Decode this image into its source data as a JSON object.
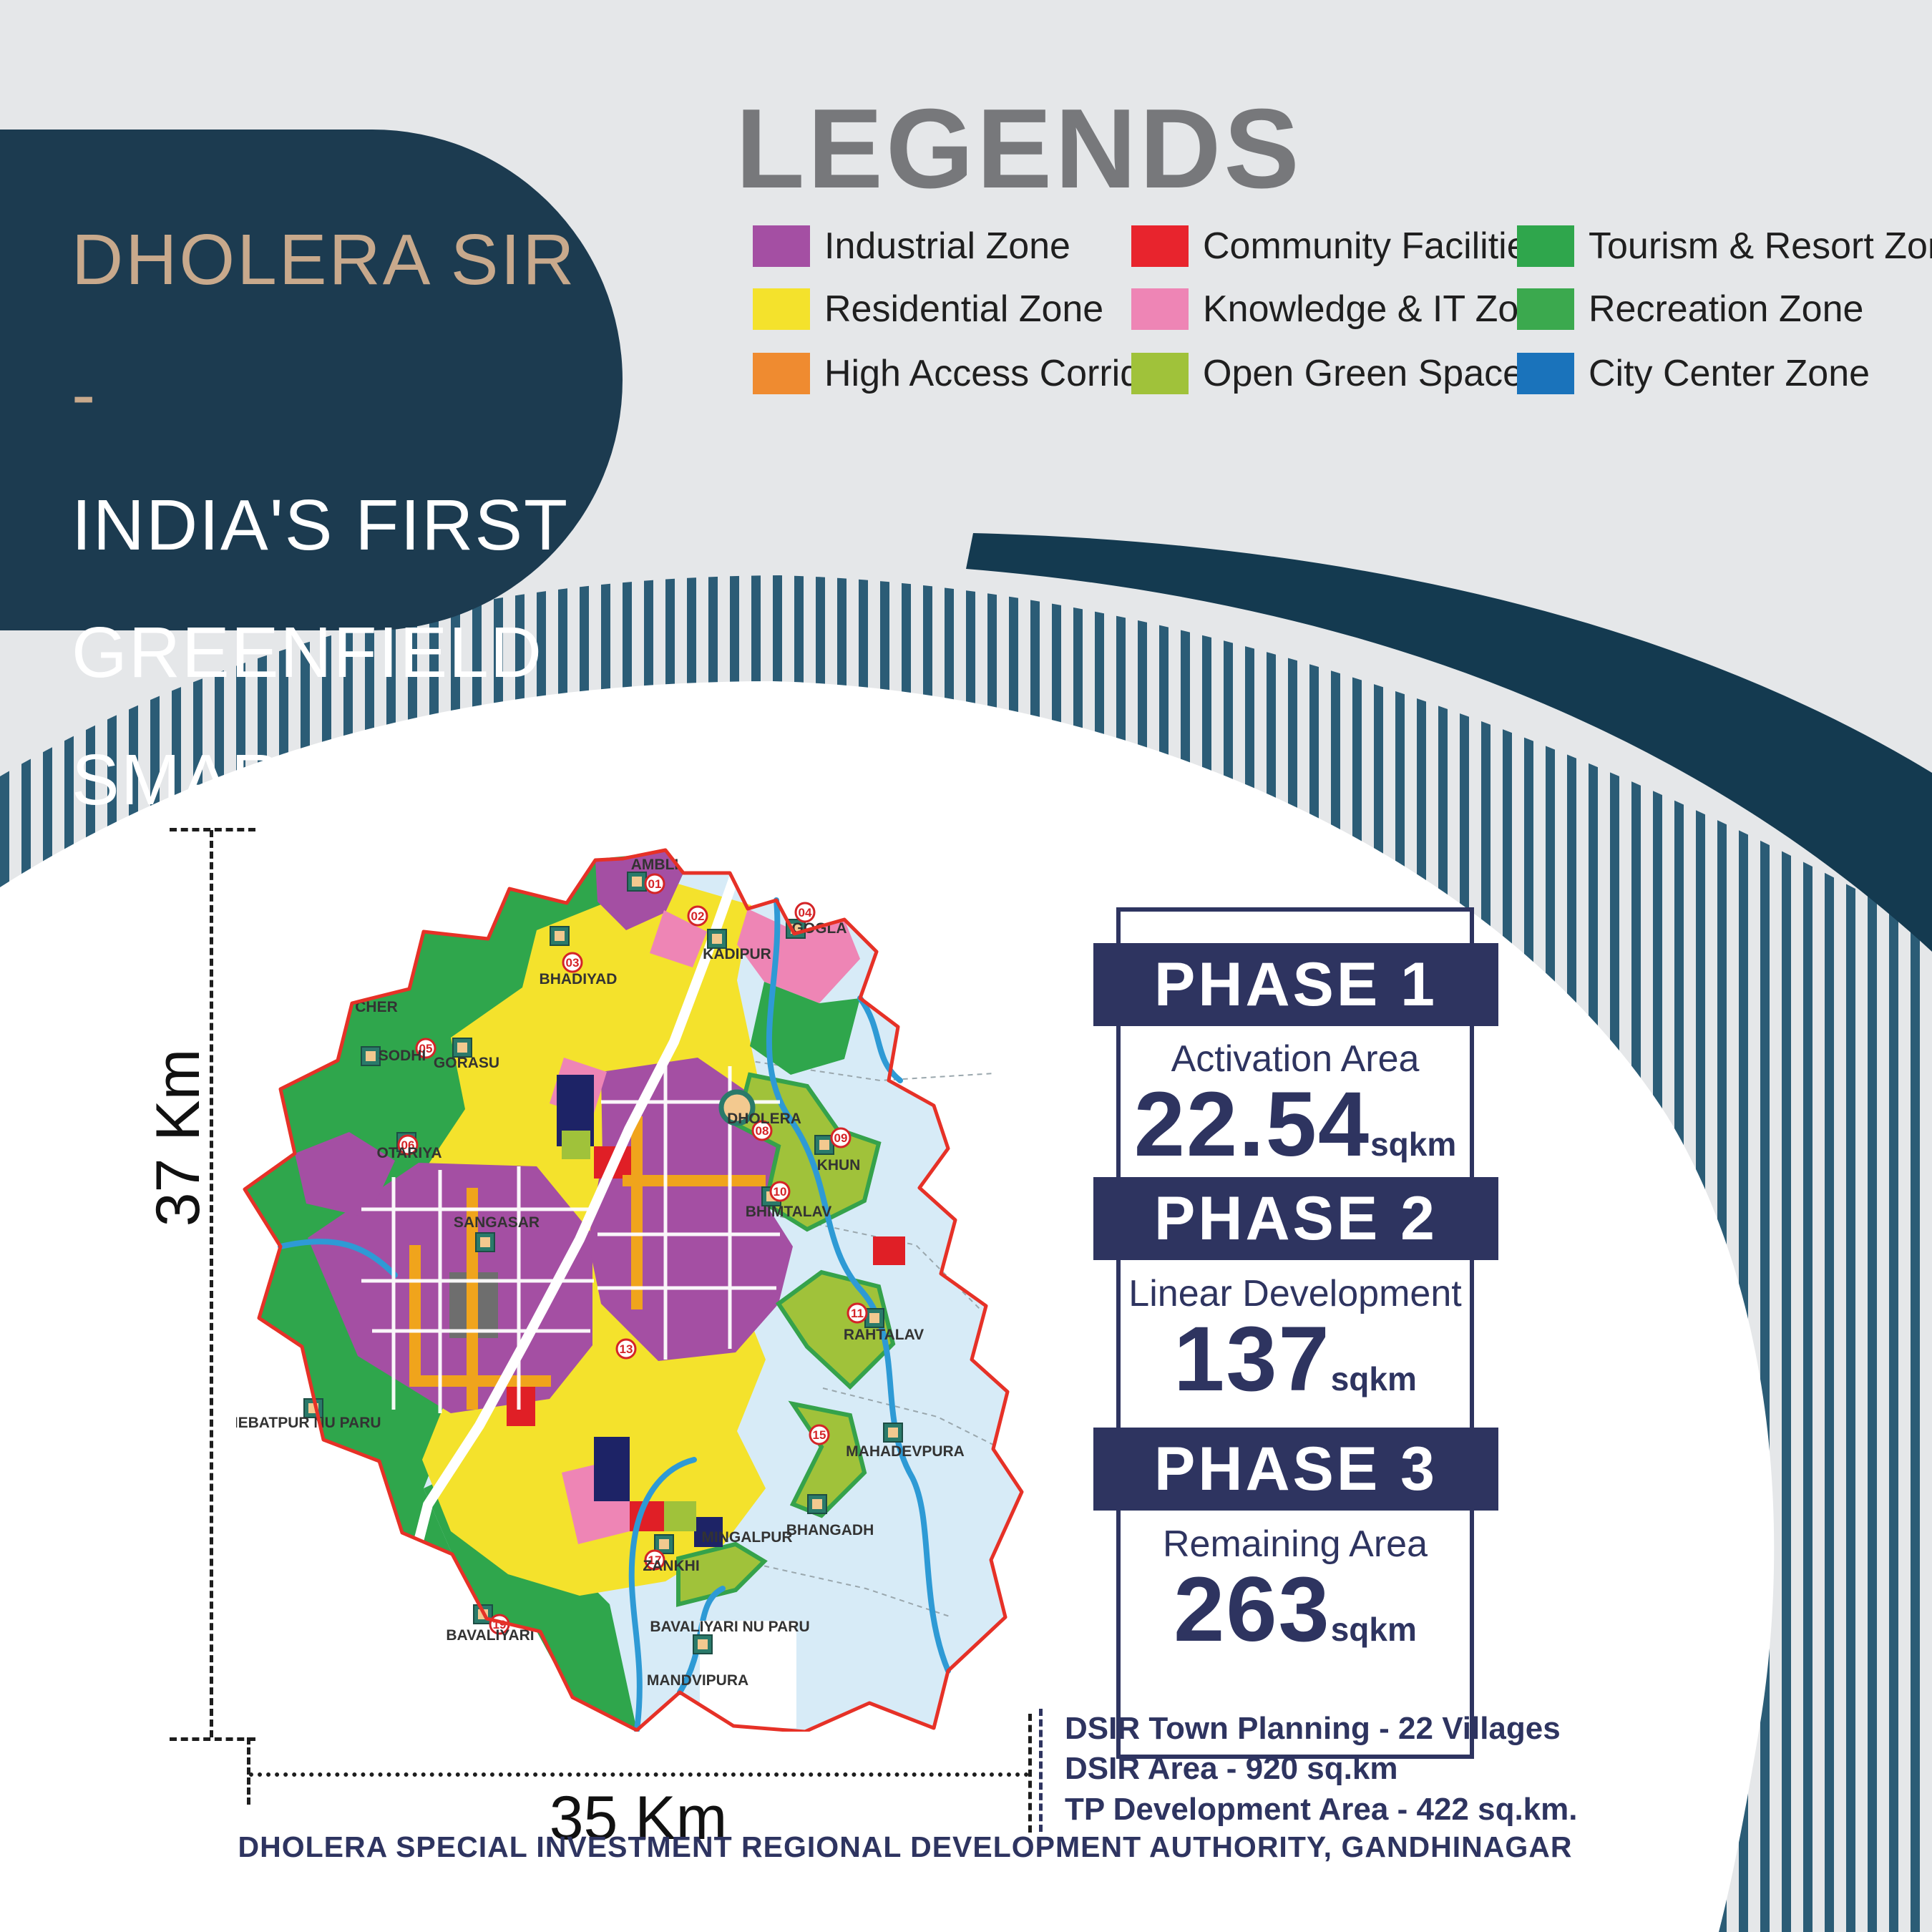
{
  "theme": {
    "background": "#e5e7e9",
    "stripe": "#2b5c76",
    "swoosh": "#143a50",
    "circle": "#ffffff",
    "title_box": "#1c3b50",
    "title_accent": "#c8a98c",
    "heading_gray": "#77787b",
    "navy": "#2e3460"
  },
  "title": {
    "line1": "DHOLERA SIR -",
    "line2": "INDIA'S FIRST GREENFIELD",
    "line3": "SMART CITY"
  },
  "legend": {
    "heading": "LEGENDS",
    "items": [
      {
        "key": "industrial",
        "label": "Industrial Zone",
        "color": "#a44fa3"
      },
      {
        "key": "residential",
        "label": "Residential Zone",
        "color": "#f4e22c"
      },
      {
        "key": "corridor",
        "label": "High Access Corridor",
        "color": "#ef8b30"
      },
      {
        "key": "community",
        "label": "Community Facilities",
        "color": "#e8242d"
      },
      {
        "key": "knowledge",
        "label": "Knowledge & IT Zone",
        "color": "#ee85b5"
      },
      {
        "key": "open",
        "label": "Open Green Space",
        "color": "#a0c23a"
      },
      {
        "key": "tourism",
        "label": "Tourism & Resort Zone",
        "color": "#2fa64c"
      },
      {
        "key": "recreation",
        "label": "Recreation Zone",
        "color": "#3ba94e"
      },
      {
        "key": "citycenter",
        "label": "City Center Zone",
        "color": "#1a73bb"
      }
    ]
  },
  "phases": [
    {
      "name": "PHASE 1",
      "subtitle": "Activation Area",
      "value": "22.54",
      "unit": "sqkm"
    },
    {
      "name": "PHASE 2",
      "subtitle": "Linear Development",
      "value": "137",
      "unit": "sqkm"
    },
    {
      "name": "PHASE 3",
      "subtitle": "Remaining Area",
      "value": "263",
      "unit": "sqkm"
    }
  ],
  "stats": {
    "line1": "DSIR Town Planning - 22 Villages",
    "line2": "DSIR Area - 920 sq.km",
    "line3": "TP Development Area - 422 sq.km."
  },
  "footer": "DHOLERA SPECIAL INVESTMENT REGIONAL DEVELOPMENT AUTHORITY, GANDHINAGAR",
  "dimensions": {
    "height_label": "37 Km",
    "width_label": "35 Km"
  },
  "map": {
    "colors": {
      "water": "#d7ebf7",
      "river": "#2e9ad5",
      "boundary_red": "#e63127",
      "road_orange": "#f0a41c",
      "navy_block": "#1d2366",
      "red_block": "#e01f26",
      "gray_block": "#6e6e6e",
      "lime_stroke": "#35a24b",
      "marker_teal": "#2a7a6a",
      "marker_sand": "#f3c98f"
    },
    "labels": [
      "AMBLI",
      "KADIPUR",
      "GOGLA",
      "BHADIYAD",
      "DHOLERA",
      "KHUN",
      "BHIMTALAV",
      "GORASU",
      "OTARIYA",
      "CHER",
      "SODHI",
      "SANGASAR",
      "RAHTALAV",
      "MAHADEVPURA",
      "BHANGADH",
      "MINGALPUR",
      "ZANKHI",
      "BAVALIYARI NU PARU",
      "HEBATPUR NU PARU",
      "BAVALIYARI",
      "MANDVIPURA"
    ],
    "badges": [
      "01",
      "02",
      "03",
      "04",
      "05",
      "06",
      "08",
      "09",
      "10",
      "11",
      "13",
      "15",
      "17",
      "19"
    ]
  }
}
